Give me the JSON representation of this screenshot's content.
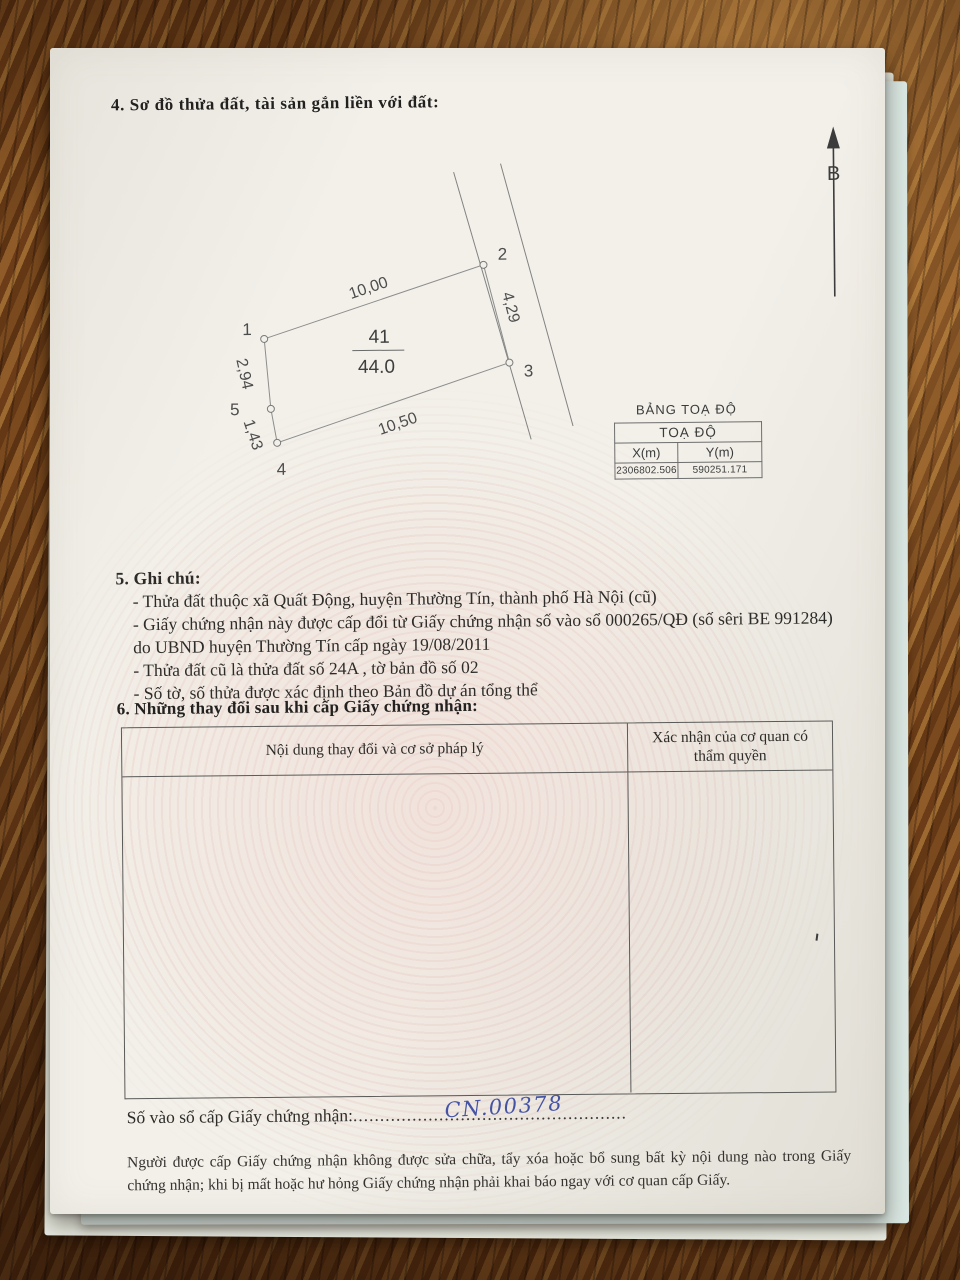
{
  "section4": {
    "title": "4. Sơ đồ thửa đất, tài sản gắn liền với đất:"
  },
  "north": {
    "label": "B"
  },
  "diagram": {
    "parcel_number": "41",
    "area": "44.0",
    "points": {
      "p1": "1",
      "p2": "2",
      "p3": "3",
      "p4": "4",
      "p5": "5"
    },
    "edges": {
      "top": "10,00",
      "right": "4,29",
      "bottom": "10,50",
      "left_upper": "2,94",
      "left_lower": "1,43"
    }
  },
  "coord_table": {
    "title": "BẢNG TOẠ ĐỘ",
    "header": "TOẠ ĐỘ",
    "col_x": "X(m)",
    "col_y": "Y(m)",
    "x_value": "2306802.506",
    "y_value": "590251.171"
  },
  "section5": {
    "heading": "5. Ghi chú:",
    "lines": [
      "- Thửa đất thuộc xã Quất Động, huyện Thường Tín, thành phố Hà Nội (cũ)",
      "- Giấy chứng nhận này được cấp đổi từ Giấy chứng nhận số vào sổ 000265/QĐ (số sêri BE 991284) do UBND huyện Thường Tín cấp ngày 19/08/2011",
      "- Thửa đất cũ là thửa đất số 24A , tờ bản đồ số 02",
      "- Số tờ, số thửa được xác định theo Bản đồ dự án tổng thể"
    ]
  },
  "section6": {
    "heading": "6. Những thay đổi sau khi cấp Giấy chứng nhận:",
    "col1_header": "Nội dung thay đổi và cơ sở pháp lý",
    "col2_header": "Xác nhận của cơ quan có thẩm quyền"
  },
  "registry": {
    "label": "Số vào sổ cấp Giấy chứng nhận:",
    "dots": "...................................................",
    "handwritten": "CN.00378"
  },
  "footer": {
    "text": "Người được cấp Giấy chứng nhận không được sửa chữa, tẩy xóa hoặc bổ sung bất kỳ nội dung nào trong Giấy chứng nhận; khi bị mất hoặc hư hỏng Giấy chứng nhận phải khai báo ngay với cơ quan cấp Giấy."
  }
}
